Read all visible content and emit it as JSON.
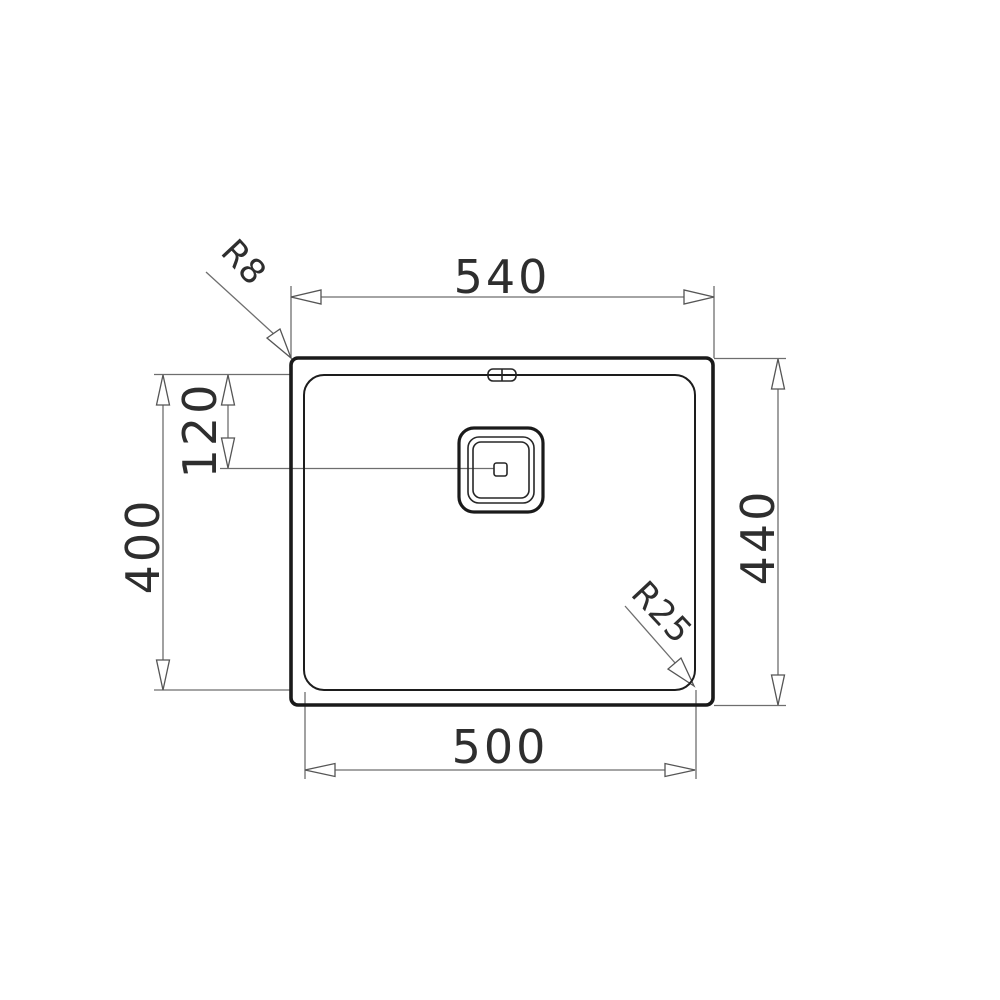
{
  "drawing": {
    "background_color": "#ffffff",
    "ink_color": "#1a1a1a",
    "dimension_line_color": "#6e6e6e",
    "labels": {
      "top_width": "540",
      "bottom_width": "500",
      "left_height": "400",
      "right_height": "440",
      "drain_offset": "120",
      "outer_corner_radius": "R8",
      "bowl_corner_radius": "R25"
    }
  }
}
